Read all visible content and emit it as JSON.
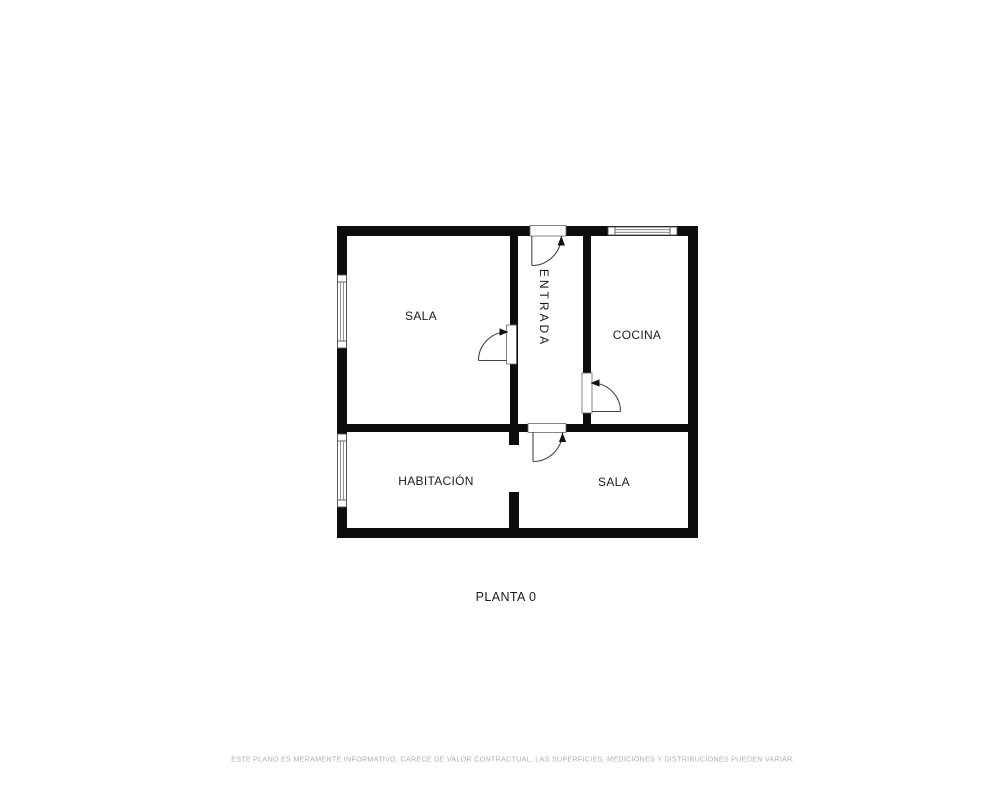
{
  "plan": {
    "title": "PLANTA 0",
    "rooms": [
      {
        "label": "SALA"
      },
      {
        "label": "ENTRADA"
      },
      {
        "label": "COCINA"
      },
      {
        "label": "HABITACIÓN"
      },
      {
        "label": "SALA"
      }
    ],
    "disclaimer": "ESTE PLANO ES MERAMENTE INFORMATIVO, CARECE DE VALOR CONTRACTUAL, LAS SUPERFICIES, MEDICIONES Y DISTRIBUCIONES PUEDEN VARIAR.",
    "colors": {
      "wall": "#0d0d0d",
      "label": "#1c1c1c",
      "disclaimer": "#b0b0b0",
      "background": "#ffffff"
    }
  }
}
